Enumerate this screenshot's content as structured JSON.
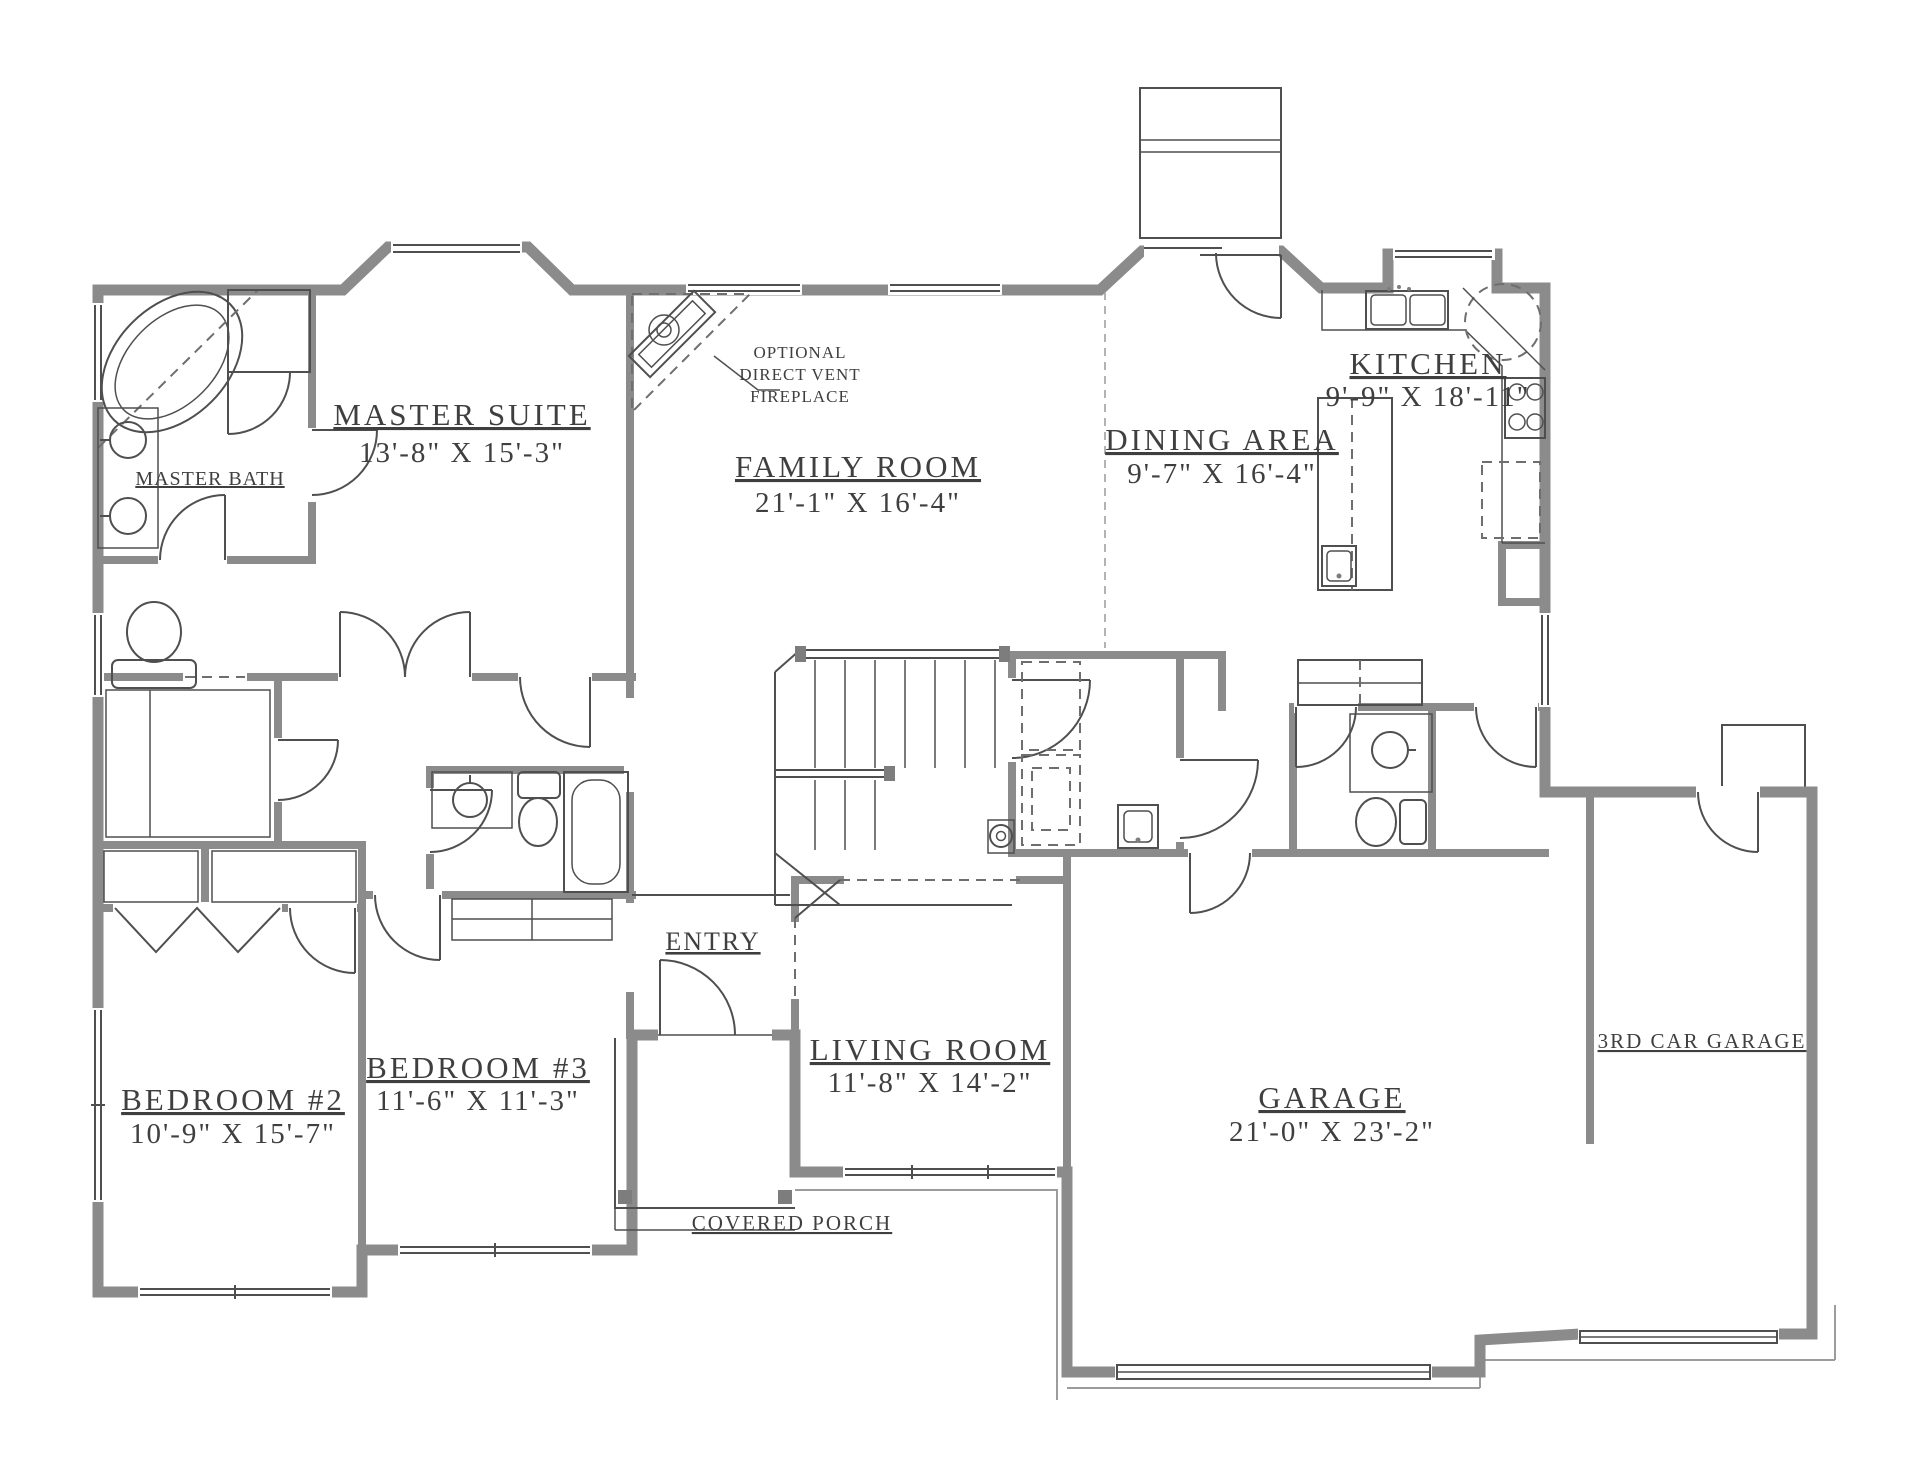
{
  "colors": {
    "background": "#ffffff",
    "wall": "#8b8b8b",
    "line": "#4f4f4f",
    "dashed": "#6e6e6e",
    "text": "#3f3f3f"
  },
  "rooms": [
    {
      "id": "master-suite",
      "label": "MASTER SUITE",
      "dims": "13'-8\" X 15'-3\""
    },
    {
      "id": "master-bath",
      "label": "MASTER BATH",
      "dims": ""
    },
    {
      "id": "family-room",
      "label": "FAMILY ROOM",
      "dims": "21'-1\" X 16'-4\""
    },
    {
      "id": "kitchen",
      "label": "KITCHEN",
      "dims": "9'-9\" X 18'-11\""
    },
    {
      "id": "dining-area",
      "label": "DINING AREA",
      "dims": "9'-7\" X 16'-4\""
    },
    {
      "id": "bedroom-2",
      "label": "BEDROOM #2",
      "dims": "10'-9\" X 15'-7\""
    },
    {
      "id": "bedroom-3",
      "label": "BEDROOM #3",
      "dims": "11'-6\" X 11'-3\""
    },
    {
      "id": "entry",
      "label": "ENTRY",
      "dims": ""
    },
    {
      "id": "living-room",
      "label": "LIVING ROOM",
      "dims": "11'-8\" X 14'-2\""
    },
    {
      "id": "garage",
      "label": "GARAGE",
      "dims": "21'-0\" X 23'-2\""
    },
    {
      "id": "third-car-garage",
      "label": "3RD CAR GARAGE",
      "dims": ""
    },
    {
      "id": "covered-porch",
      "label": "COVERED PORCH",
      "dims": ""
    }
  ],
  "annotations": {
    "fireplace_line1": "OPTIONAL",
    "fireplace_line2": "DIRECT VENT",
    "fireplace_line3": "FIREPLACE"
  }
}
